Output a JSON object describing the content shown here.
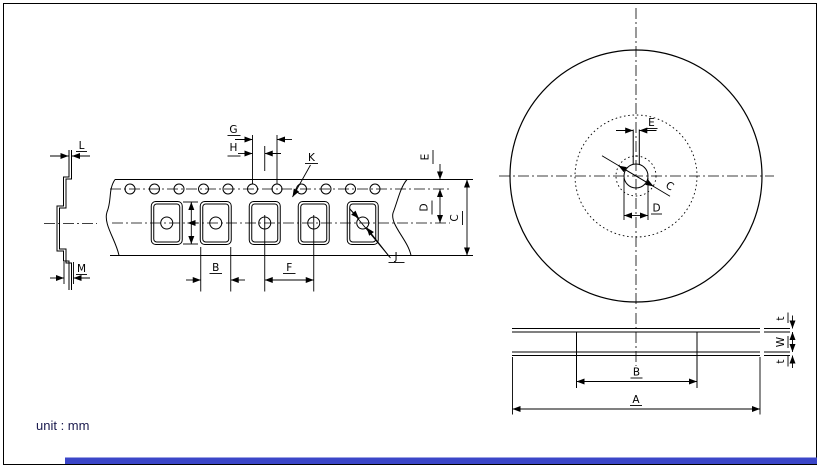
{
  "unit_note": "unit : mm",
  "tape": {
    "L": "L",
    "M": "M",
    "G": "G",
    "H": "H",
    "K": "K",
    "B": "B",
    "F": "F",
    "J": "J",
    "E": "E",
    "D": "D",
    "C": "C"
  },
  "reel_front": {
    "E": "E",
    "C": "C",
    "D": "D"
  },
  "reel_side": {
    "A": "A",
    "B": "B",
    "t_top": "t",
    "W": "W",
    "t_bottom": "t"
  },
  "colors": {
    "line": "#000000",
    "text": "#000000",
    "note_text": "#1b1b4e",
    "bottom_bar": "#3b46c8",
    "background": "#ffffff"
  }
}
